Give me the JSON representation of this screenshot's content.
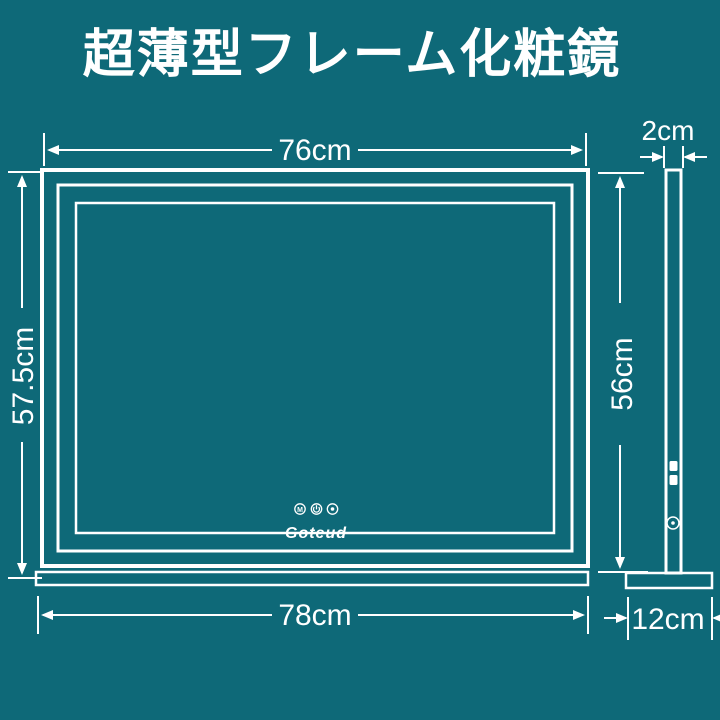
{
  "title": "超薄型フレーム化粧鏡",
  "colors": {
    "background": "#0E6978",
    "line": "#FFFFFF"
  },
  "front_view": {
    "width_label": "76cm",
    "height_label": "57.5cm",
    "base_width_label": "78cm",
    "brand": "Goteud",
    "touch_buttons": [
      {
        "name": "m-touch-icon",
        "glyph": "M"
      },
      {
        "name": "power-touch-icon"
      },
      {
        "name": "dimmer-touch-icon"
      }
    ]
  },
  "side_view": {
    "thickness_label": "2cm",
    "height_label": "56cm",
    "base_depth_label": "12cm"
  }
}
